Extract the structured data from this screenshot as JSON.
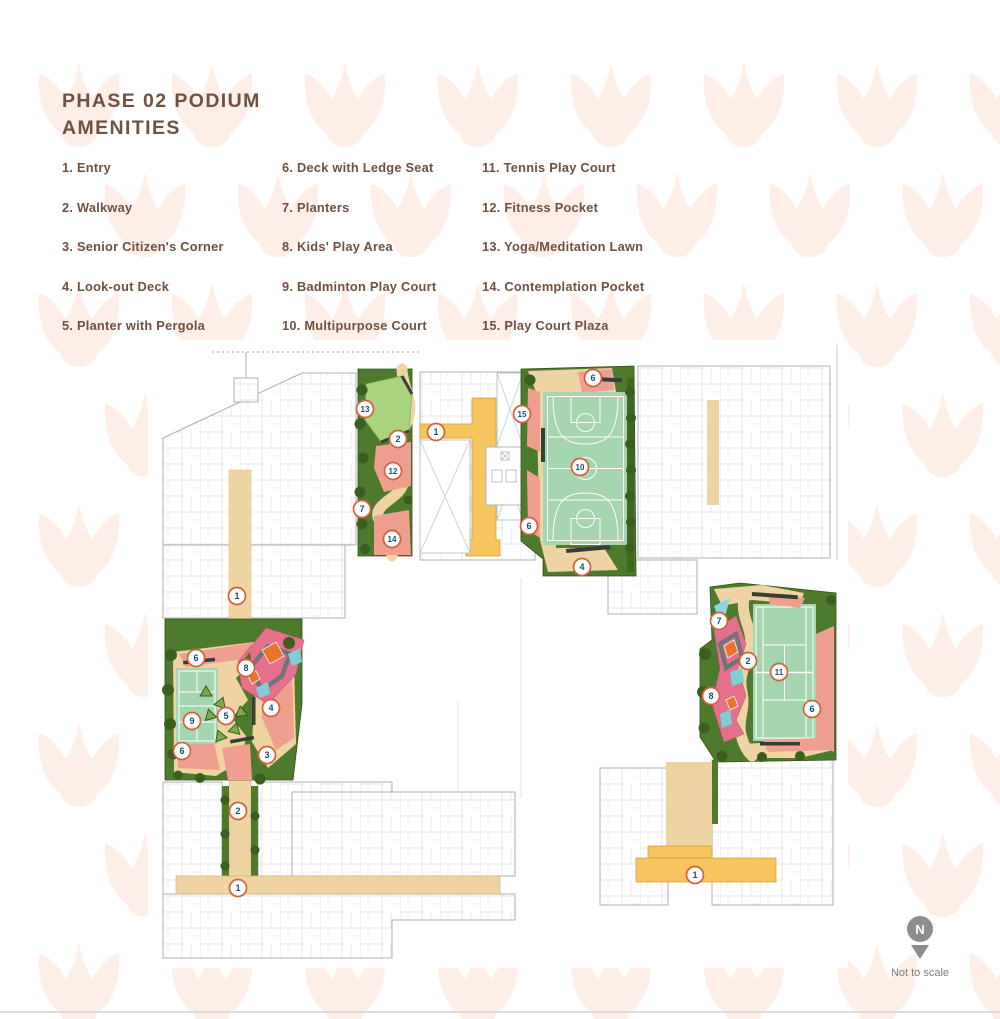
{
  "title": {
    "pre": "PHASE",
    "number": "02",
    "post": "PODIUM",
    "line2": "AMENITIES"
  },
  "legend": {
    "columns": [
      [
        "1. Entry",
        "2. Walkway",
        "3. Senior Citizen's Corner",
        "4. Look-out Deck",
        "5. Planter with Pergola"
      ],
      [
        "6. Deck with Ledge Seat",
        "7. Planters",
        "8. Kids' Play Area",
        "9. Badminton Play Court",
        "10. Multipurpose Court"
      ],
      [
        "11. Tennis Play Court",
        "12. Fitness Pocket",
        "13. Yoga/Meditation Lawn",
        "14. Contemplation Pocket",
        "15. Play Court Plaza"
      ]
    ]
  },
  "plan": {
    "markers": [
      {
        "n": "13",
        "x": 365,
        "y": 409
      },
      {
        "n": "2",
        "x": 398,
        "y": 439
      },
      {
        "n": "1",
        "x": 436,
        "y": 432
      },
      {
        "n": "12",
        "x": 393,
        "y": 471
      },
      {
        "n": "7",
        "x": 362,
        "y": 509
      },
      {
        "n": "14",
        "x": 392,
        "y": 539
      },
      {
        "n": "15",
        "x": 522,
        "y": 414
      },
      {
        "n": "6",
        "x": 593,
        "y": 378
      },
      {
        "n": "10",
        "x": 580,
        "y": 467
      },
      {
        "n": "6",
        "x": 529,
        "y": 526
      },
      {
        "n": "4",
        "x": 582,
        "y": 567
      },
      {
        "n": "1",
        "x": 237,
        "y": 596
      },
      {
        "n": "6",
        "x": 196,
        "y": 658
      },
      {
        "n": "8",
        "x": 246,
        "y": 668
      },
      {
        "n": "5",
        "x": 226,
        "y": 716
      },
      {
        "n": "4",
        "x": 271,
        "y": 708
      },
      {
        "n": "9",
        "x": 192,
        "y": 721
      },
      {
        "n": "3",
        "x": 267,
        "y": 755
      },
      {
        "n": "6",
        "x": 182,
        "y": 751
      },
      {
        "n": "2",
        "x": 238,
        "y": 811
      },
      {
        "n": "1",
        "x": 238,
        "y": 888
      },
      {
        "n": "7",
        "x": 719,
        "y": 621
      },
      {
        "n": "2",
        "x": 748,
        "y": 661
      },
      {
        "n": "11",
        "x": 779,
        "y": 672
      },
      {
        "n": "8",
        "x": 711,
        "y": 696
      },
      {
        "n": "6",
        "x": 812,
        "y": 709
      },
      {
        "n": "1",
        "x": 695,
        "y": 875
      }
    ]
  },
  "north": {
    "label": "N",
    "note": "Not to scale"
  },
  "colors": {
    "title_brown": "#6e5140",
    "marker_ring": "#d4603c",
    "marker_number": "#1b4d72",
    "watermark": "#fdeee8",
    "tan_deck": "#eed4a2",
    "yellow_walk": "#f6c55e",
    "planting_green": "#4d7a2c",
    "lawn_green": "#a9d37f",
    "court_green": "#a5d5ae",
    "salmon_pocket": "#ef9f90"
  }
}
